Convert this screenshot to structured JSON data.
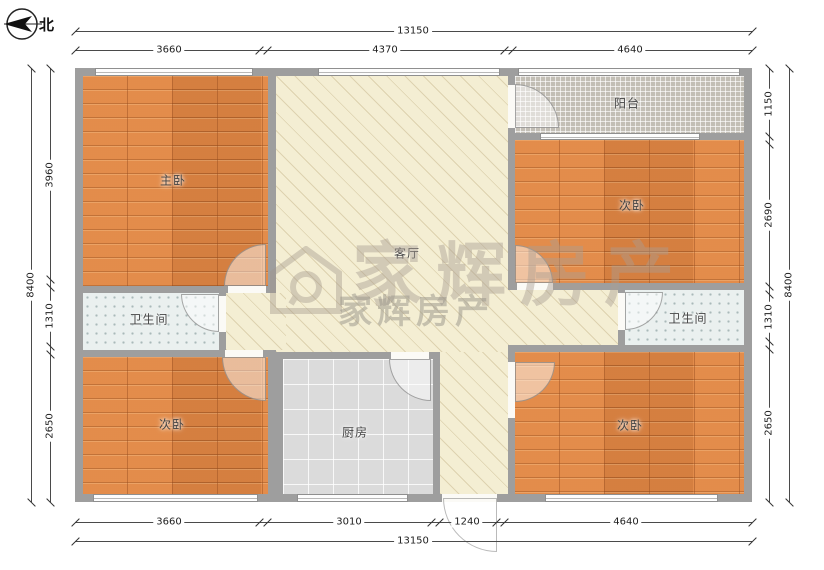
{
  "compass": {
    "label": "北"
  },
  "watermark": {
    "brand": "家辉房产",
    "brand_small": "家辉房产"
  },
  "rooms": {
    "master": "主卧",
    "living": "客厅",
    "balcony": "阳台",
    "bed_right_top": "次卧",
    "bath_left": "卫生间",
    "bath_right": "卫生间",
    "bed_left_bottom": "次卧",
    "kitchen": "厨房",
    "bed_right_bottom": "次卧"
  },
  "dimensions": {
    "top": {
      "total": "13150",
      "segments": [
        "3660",
        "4370",
        "4640"
      ]
    },
    "bottom": {
      "total": "13150",
      "segments": [
        "3660",
        "3010",
        "1240",
        "4640"
      ]
    },
    "left": {
      "total": "8400",
      "segments": [
        "3960",
        "1310",
        "2650"
      ]
    },
    "right": {
      "total": "8400",
      "segments": [
        "1150",
        "2690",
        "1310",
        "2650"
      ]
    }
  },
  "colors": {
    "wall": "#9e9e9e",
    "wood_floor": "#de8544",
    "living_floor": "#f4eed3",
    "balcony_tile": "#ccc8bf",
    "bath_tile": "#eaf0ef",
    "kitchen_tile": "#dbdbdb"
  }
}
